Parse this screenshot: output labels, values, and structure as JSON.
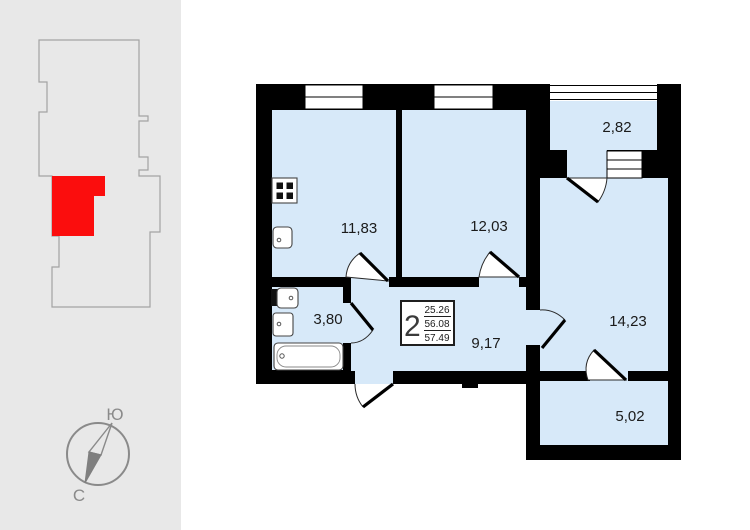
{
  "left_panel": {
    "compass": {
      "top_label": "Ю",
      "bottom_label": "С"
    }
  },
  "floor_plan": {
    "rooms": {
      "kitchen_area": "11,83",
      "bedroom_area": "12,03",
      "balcony_area": "2,82",
      "living_room_area": "14,23",
      "hallway_area": "9,17",
      "loggia_area": "5,02",
      "bathroom_area": "3,80"
    },
    "info_box": {
      "room_count": "2",
      "living_area": "25.26",
      "floor_area": "56.08",
      "total_area": "57.49"
    }
  },
  "colors": {
    "room_fill": "#d7e9f9",
    "wall": "#000000",
    "highlight_red": "#fb0d0d",
    "panel_bg": "#e8e8e8",
    "outline_gray": "#a3a3a3",
    "compass_gray": "#8a8a8a"
  }
}
